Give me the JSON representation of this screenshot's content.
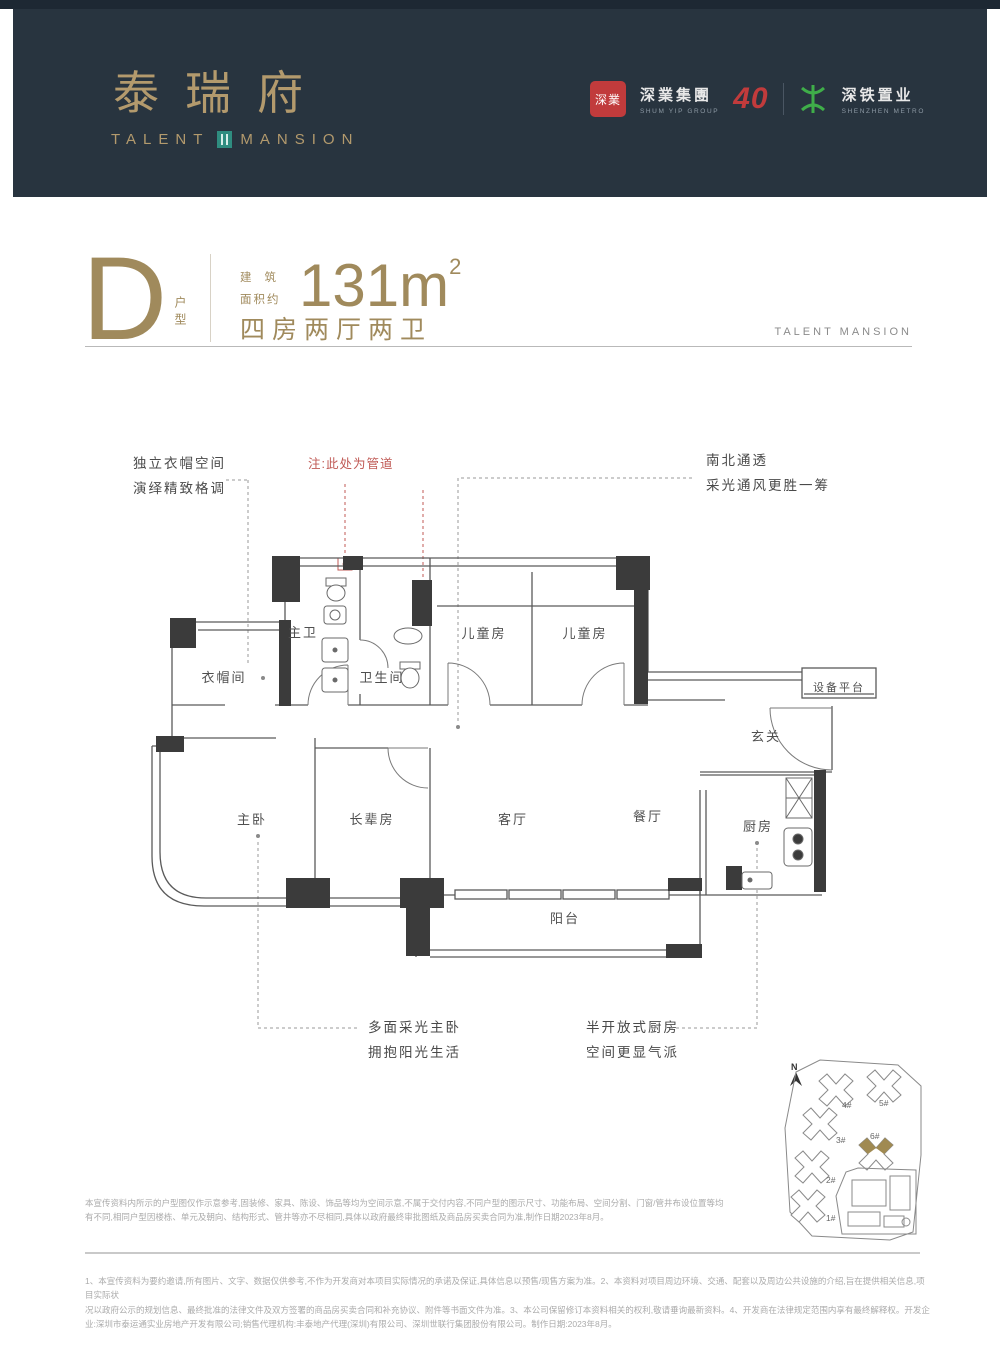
{
  "header": {
    "brand_cn": "泰瑞府",
    "brand_en_left": "TALENT",
    "brand_en_right": "MANSION",
    "logos": {
      "shumyip_badge": "深業",
      "shumyip_cn": "深業集團",
      "shumyip_en": "SHUM YIP GROUP",
      "anniversary": "40",
      "metro_cn": "深铁置业",
      "metro_en": "SHENZHEN METRO"
    }
  },
  "unit": {
    "letter": "D",
    "letter_sub": "户型",
    "area_prefix_l1": "建筑",
    "area_prefix_l2": "面积约",
    "area_value": "131m",
    "area_sup": "2",
    "layout": "四房两厅两卫",
    "watermark": "TALENT MANSION"
  },
  "annotations": {
    "top_left_l1": "独立衣帽空间",
    "top_left_l2": "演绎精致格调",
    "pipe_note": "注:此处为管道",
    "top_right_l1": "南北通透",
    "top_right_l2": "采光通风更胜一筹",
    "bottom_left_l1": "多面采光主卧",
    "bottom_left_l2": "拥抱阳光生活",
    "bottom_right_l1": "半开放式厨房",
    "bottom_right_l2": "空间更显气派"
  },
  "rooms": {
    "master_bath": "主卫",
    "closet": "衣帽间",
    "bath2": "卫生间",
    "kids1": "儿童房",
    "kids2": "儿童房",
    "equipment": "设备平台",
    "foyer": "玄关",
    "master_bed": "主卧",
    "elder_room": "长辈房",
    "living": "客厅",
    "dining": "餐厅",
    "kitchen": "厨房",
    "balcony": "阳台"
  },
  "siteplan": {
    "north": "N",
    "buildings": [
      "4#",
      "5#",
      "3#",
      "6#",
      "2#",
      "1#"
    ],
    "highlighted": "6#"
  },
  "disclaimers": {
    "top": "本宣传资料内所示的户型图仅作示意参考,固装修、家具、陈设、饰品等均为空间示意,不属于交付内容,不同户型的图示尺寸、功能布局、空间分割、门窗/管井布设位置等均有不同,相同户型因楼栋、单元及朝向、结构形式、管井等亦不尽相同,具体以政府最终审批图纸及商品房买卖合同为准,制作日期2023年8月。",
    "bottom_1": "1、本宣传资料为要约邀请,所有图片、文字、数据仅供参考,不作为开发商对本项目实际情况的承诺及保证,具体信息以预售/现售方案为准。2、本资料对项目周边环境、交通、配套以及周边公共设施的介绍,旨在提供相关信息,项目实际状",
    "bottom_2": "况以政府公示的规划信息、最终批准的法律文件及双方签署的商品房买卖合同和补充协议、附件等书面文件为准。3、本公司保留修订本资料相关的权利,敬请垂询最新资料。4、开发商在法律规定范围内享有最终解释权。开发企业:深圳市泰运通实业房地产开发有限公司;销售代理机构:丰泰地产代理(深圳)有限公司、深圳世联行集团股份有限公司。制作日期:2023年8月。"
  },
  "colors": {
    "header_bg": "#28343f",
    "gold": "#b39a6d",
    "gold_dark": "#a08a5c",
    "teal": "#2f8d80",
    "logo_red": "#c13b3c",
    "metro_green": "#3fae49",
    "note_red": "#c05a55",
    "wall": "#3b3b3b",
    "site_gold": "#a08a52"
  }
}
